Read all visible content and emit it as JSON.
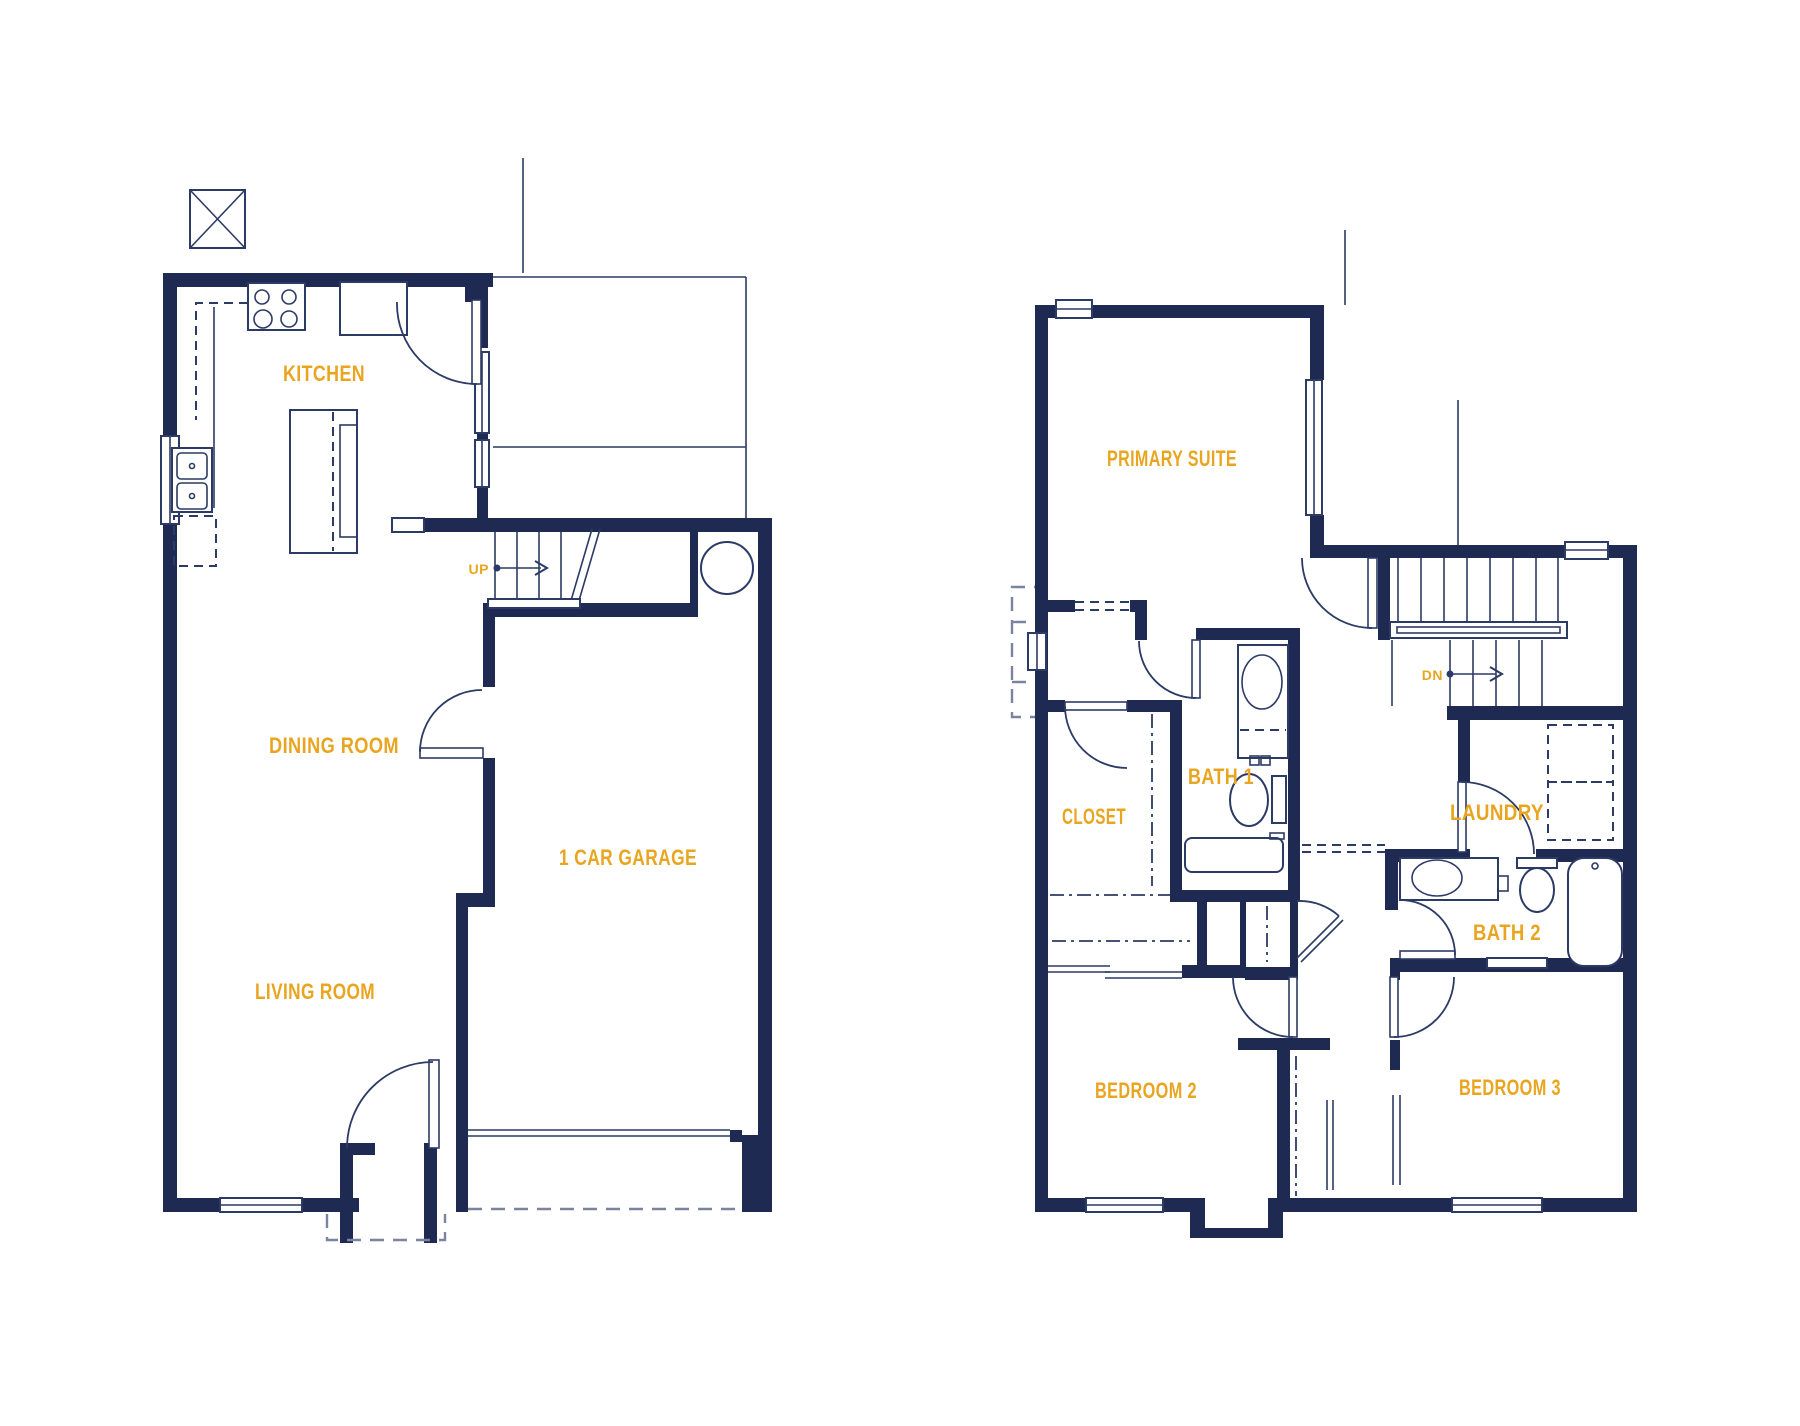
{
  "colors": {
    "background": "#ffffff",
    "wall": "#1f2a52",
    "line": "#2c3a66",
    "dashed_exterior": "#7a84a0",
    "label": "#e9a51f"
  },
  "floors": {
    "first": {
      "rooms": {
        "kitchen": "KITCHEN",
        "dining_room": "DINING ROOM",
        "living_room": "LIVING ROOM",
        "garage": "1 CAR GARAGE"
      },
      "stairs": {
        "up": "UP"
      }
    },
    "second": {
      "rooms": {
        "primary_suite": "PRIMARY SUITE",
        "closet": "CLOSET",
        "bath_1": "BATH 1",
        "laundry": "LAUNDRY",
        "bath_2": "BATH 2",
        "bedroom_2": "BEDROOM 2",
        "bedroom_3": "BEDROOM 3"
      },
      "stairs": {
        "down": "DN"
      }
    }
  }
}
